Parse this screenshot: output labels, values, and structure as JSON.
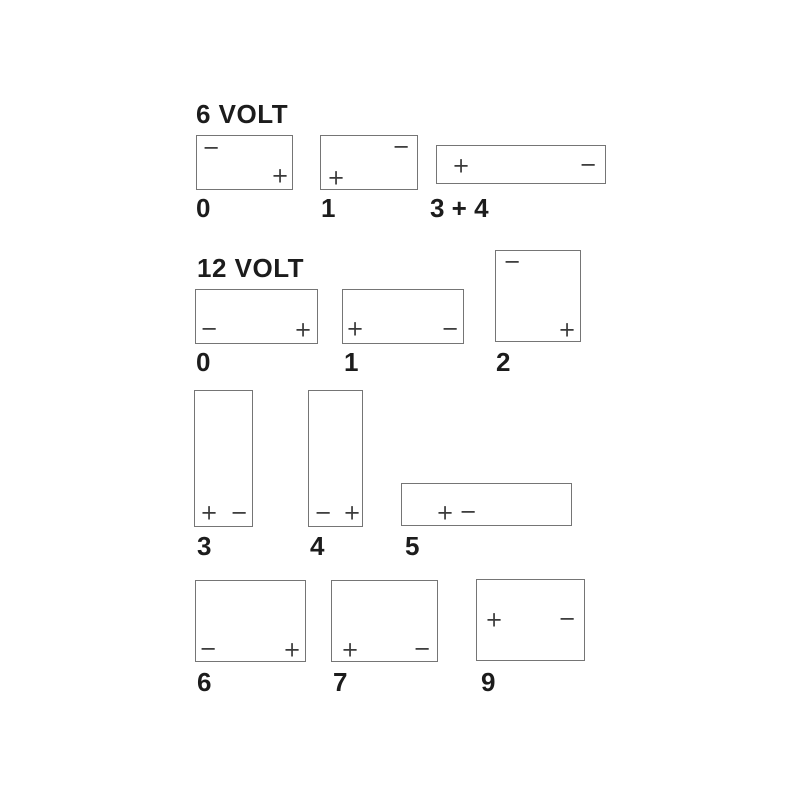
{
  "page": {
    "background_color": "#ffffff",
    "colors": {
      "box_border": "#757575",
      "terminal_sign": "#3a3a3a",
      "text": "#1c1c1c"
    }
  },
  "diagram": {
    "description": "Battery terminal layout diagrams",
    "sections": [
      {
        "heading": "6 VOLT",
        "layouts": [
          {
            "label": "0",
            "terminals": [
              {
                "sign": "−",
                "position": "top-left"
              },
              {
                "sign": "+",
                "position": "bottom-right"
              }
            ]
          },
          {
            "label": "1",
            "terminals": [
              {
                "sign": "−",
                "position": "top-right"
              },
              {
                "sign": "+",
                "position": "bottom-left"
              }
            ]
          },
          {
            "label": "3 + 4",
            "terminals": [
              {
                "sign": "+",
                "position": "middle-left"
              },
              {
                "sign": "−",
                "position": "middle-right"
              }
            ]
          }
        ]
      },
      {
        "heading": "12 VOLT",
        "layouts": [
          {
            "label": "0",
            "terminals": [
              {
                "sign": "−",
                "position": "bottom-left"
              },
              {
                "sign": "+",
                "position": "bottom-right"
              }
            ]
          },
          {
            "label": "1",
            "terminals": [
              {
                "sign": "+",
                "position": "bottom-left"
              },
              {
                "sign": "−",
                "position": "bottom-right"
              }
            ]
          },
          {
            "label": "2",
            "terminals": [
              {
                "sign": "−",
                "position": "top-left"
              },
              {
                "sign": "+",
                "position": "bottom-right"
              }
            ]
          },
          {
            "label": "3",
            "terminals": [
              {
                "sign": "+",
                "position": "bottom-left"
              },
              {
                "sign": "−",
                "position": "bottom-right"
              }
            ]
          },
          {
            "label": "4",
            "terminals": [
              {
                "sign": "−",
                "position": "bottom-left"
              },
              {
                "sign": "+",
                "position": "bottom-right"
              }
            ]
          },
          {
            "label": "5",
            "terminals": [
              {
                "sign": "+",
                "position": "center-left"
              },
              {
                "sign": "−",
                "position": "center-left-adjacent"
              }
            ]
          },
          {
            "label": "6",
            "terminals": [
              {
                "sign": "−",
                "position": "bottom-left"
              },
              {
                "sign": "+",
                "position": "bottom-right"
              }
            ]
          },
          {
            "label": "7",
            "terminals": [
              {
                "sign": "+",
                "position": "bottom-left"
              },
              {
                "sign": "−",
                "position": "bottom-right"
              }
            ]
          },
          {
            "label": "9",
            "terminals": [
              {
                "sign": "+",
                "position": "middle-left"
              },
              {
                "sign": "−",
                "position": "middle-right"
              }
            ]
          }
        ]
      }
    ]
  }
}
